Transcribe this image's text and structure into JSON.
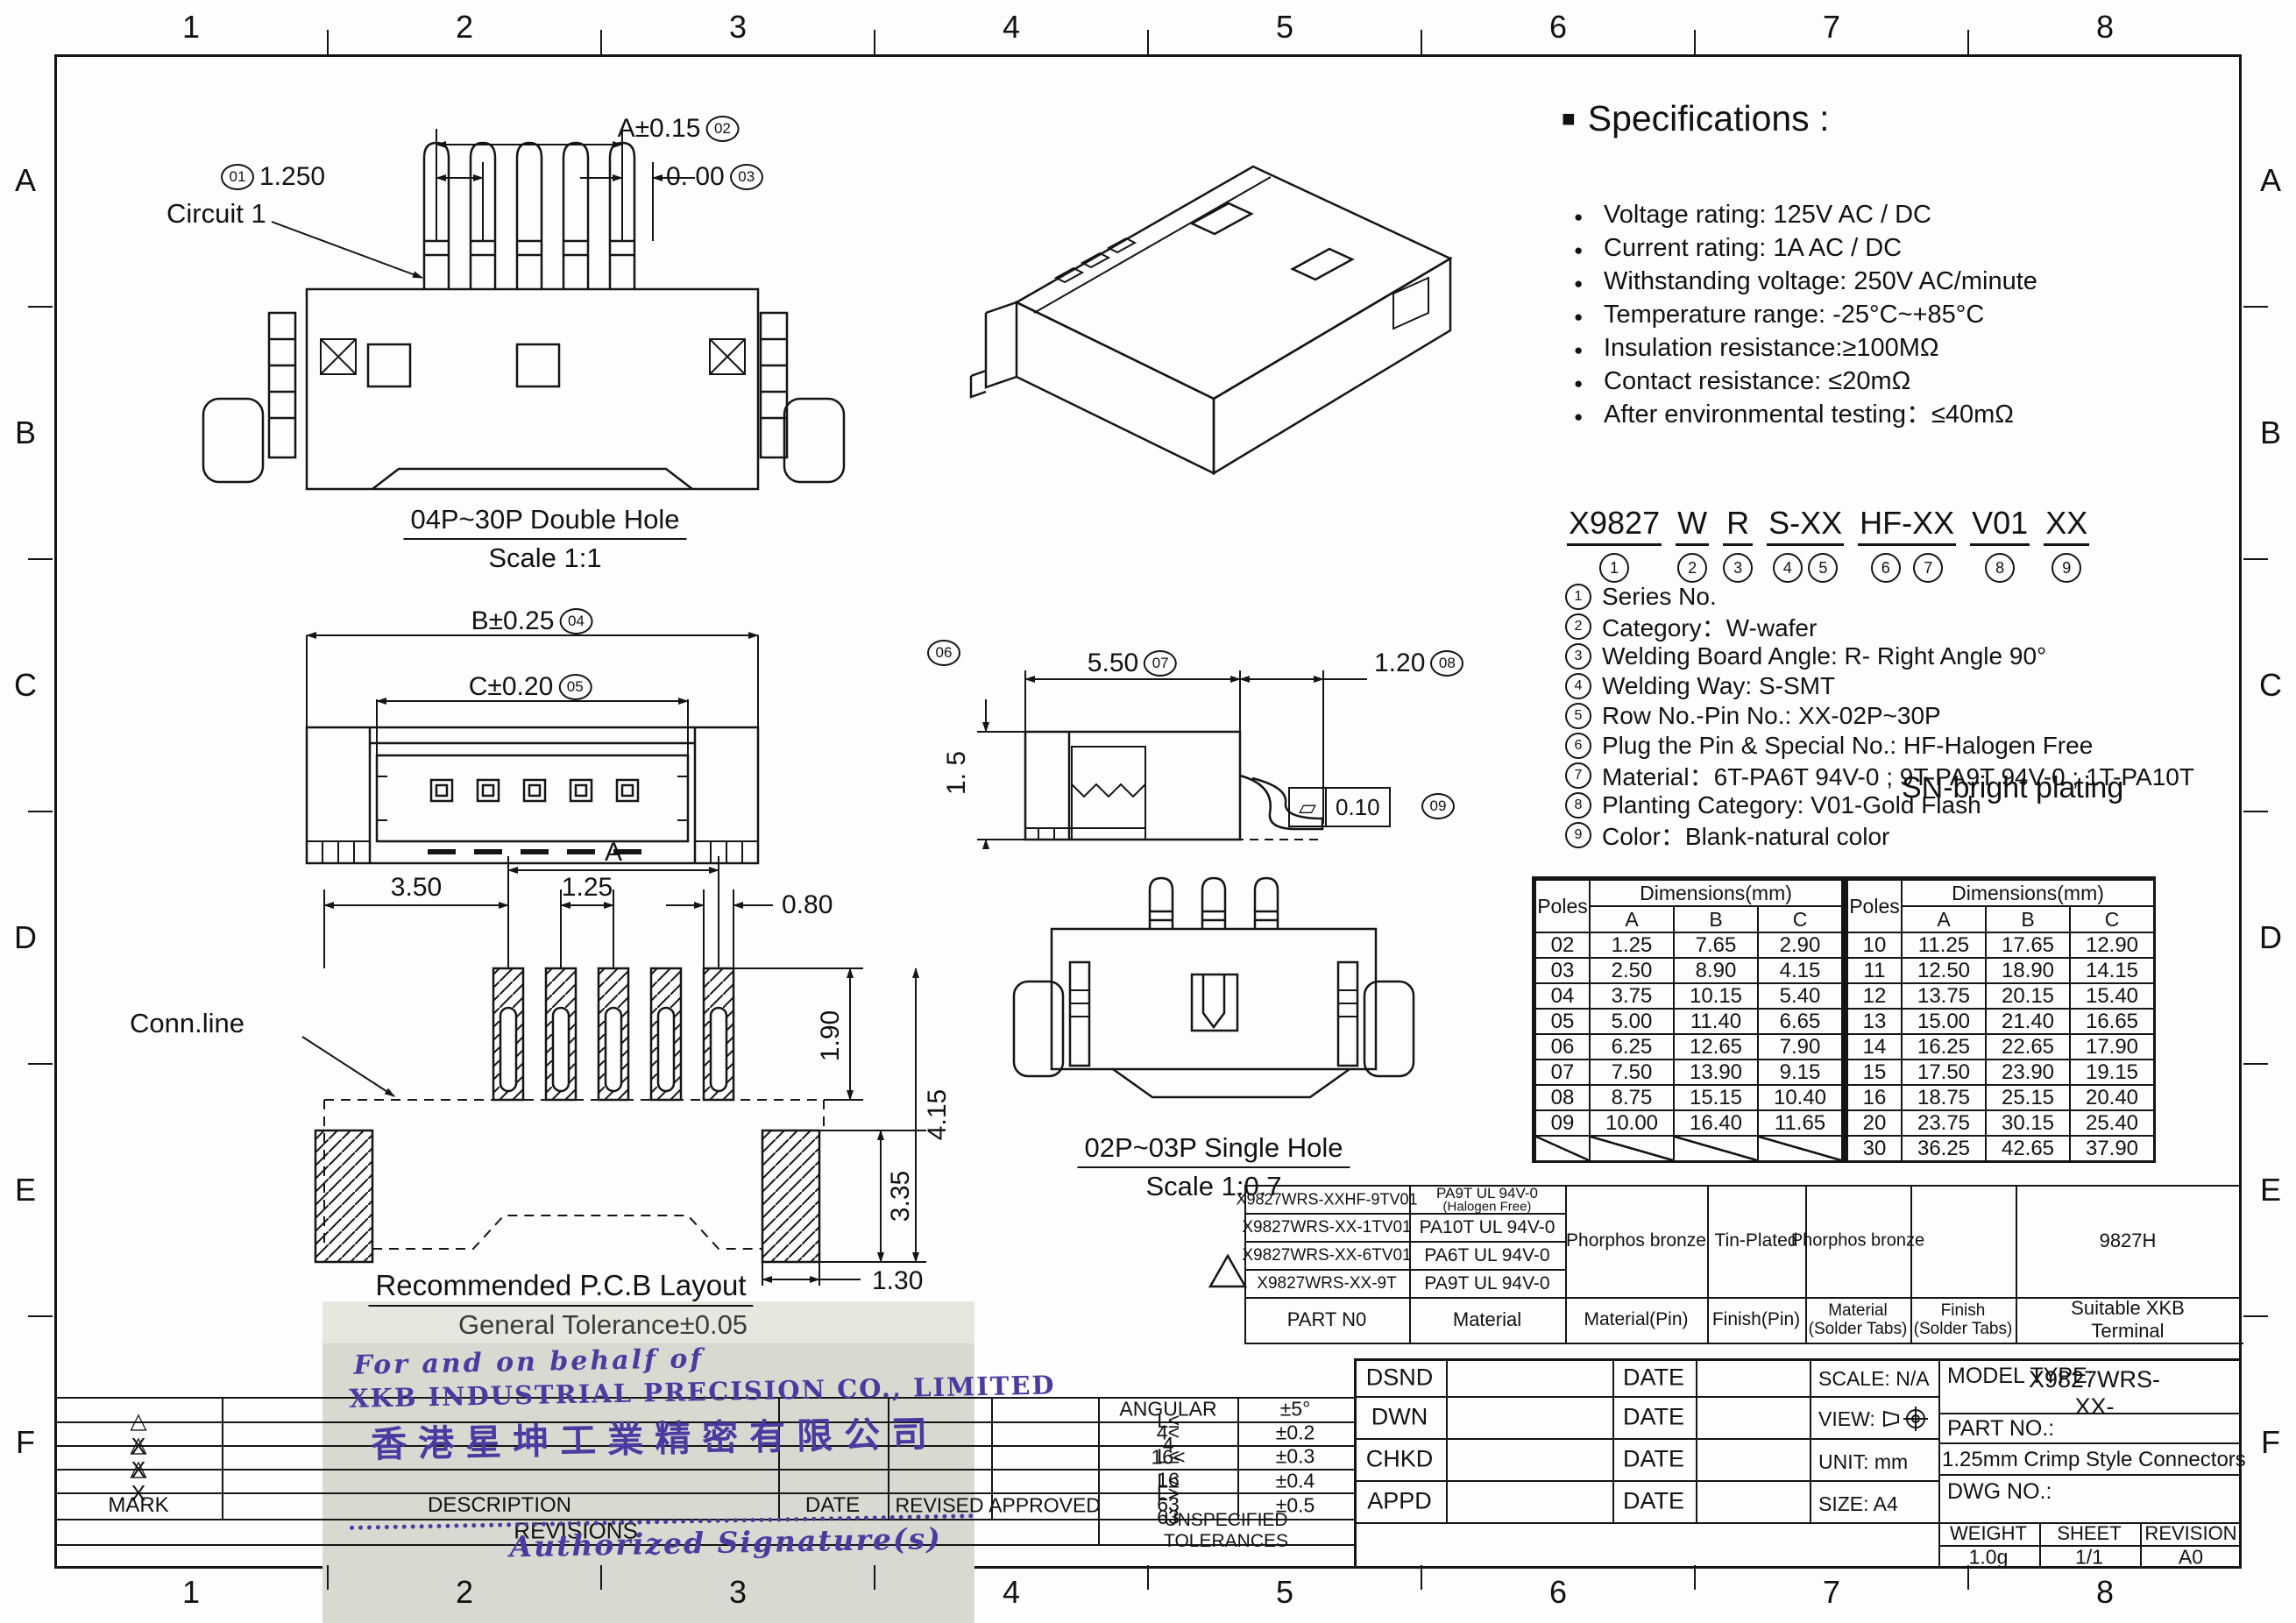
{
  "sheet": {
    "cols": [
      "1",
      "2",
      "3",
      "4",
      "5",
      "6",
      "7",
      "8"
    ],
    "rows_letters": [
      "A",
      "B",
      "C",
      "D",
      "E",
      "F"
    ]
  },
  "specs": {
    "title": "Specifications :",
    "items": [
      "Voltage rating: 125V AC / DC",
      "Current rating: 1A  AC / DC",
      "Withstanding voltage: 250V AC/minute",
      "Temperature range: -25°C~+85°C",
      "Insulation resistance:≥100MΩ",
      "Contact resistance: ≤20mΩ",
      "After environmental testing：≤40mΩ"
    ]
  },
  "part_code": {
    "segments": [
      {
        "text": "X9827",
        "refs": [
          "1"
        ]
      },
      {
        "text": "W",
        "refs": [
          "2"
        ]
      },
      {
        "text": "R",
        "refs": [
          "3"
        ]
      },
      {
        "text": "S-XX",
        "refs": [
          "4",
          "5"
        ]
      },
      {
        "text": "HF-XX",
        "refs": [
          "6",
          "7"
        ]
      },
      {
        "text": "V01",
        "refs": [
          "8"
        ]
      },
      {
        "text": "XX",
        "refs": [
          "9"
        ]
      }
    ],
    "notes": [
      {
        "ref": "1",
        "text": "Series No."
      },
      {
        "ref": "2",
        "text": "Category：W-wafer"
      },
      {
        "ref": "3",
        "text": "Welding Board Angle: R- Right Angle 90°"
      },
      {
        "ref": "4",
        "text": "Welding Way:  S-SMT"
      },
      {
        "ref": "5",
        "text": "Row No.-Pin No.:  XX-02P~30P"
      },
      {
        "ref": "6",
        "text": "Plug the Pin & Special No.: HF-Halogen Free"
      },
      {
        "ref": "7",
        "text": "Material：6T-PA6T 94V-0 ; 9T-PA9T 94V-0 ; 1T-PA10T"
      },
      {
        "ref": "8",
        "text": "Planting Category:  V01-Gold Flash"
      },
      {
        "ref": "9",
        "text": "Color：Blank-natural color"
      }
    ],
    "sn_note": "SN-bright plating"
  },
  "drawings": {
    "top_view": {
      "caption": "04P~30P Double Hole",
      "scale_note": "Scale 1:1",
      "circuit_label": "Circuit 1",
      "dim_span": "A±0.15",
      "dim_span_ref": "02",
      "dim_pitch": "1.250",
      "dim_pitch_ref": "01",
      "dim_zero": "0.  00",
      "dim_zero_ref": "03"
    },
    "front_view": {
      "dim_b": "B±0.25",
      "dim_b_ref": "04",
      "dim_c": "C±0.20",
      "dim_c_ref": "05"
    },
    "side_view": {
      "ref_height": "06",
      "dim_len": "5.50",
      "dim_len_ref": "07",
      "dim_tail": "1.20",
      "dim_tail_ref": "08",
      "dim_height": "1. 5",
      "flatness_symbol": "▱",
      "flatness_value": "0.10",
      "flatness_ref": "09"
    },
    "single_hole": {
      "caption": "02P~03P Single Hole",
      "scale_note": "Scale 1:0.7"
    },
    "pcb": {
      "caption": "Recommended P.C.B Layout",
      "tolerance_note": "General Tolerance±0.05",
      "conn_label": "Conn.line",
      "dim_offset": "3.50",
      "dim_pitch": "1.25",
      "dim_pad_w": "0.80",
      "dim_pad_h": "1.90",
      "dim_total_h": "4.15",
      "dim_tab_h": "3.35",
      "dim_tab_w": "1.30",
      "dim_span": "A"
    }
  },
  "chart_data": {
    "type": "table",
    "title": "Poles Dimensions(mm)",
    "columns": [
      "Poles",
      "A",
      "B",
      "C"
    ],
    "rows": [
      [
        "02",
        "1.25",
        "7.65",
        "2.90"
      ],
      [
        "03",
        "2.50",
        "8.90",
        "4.15"
      ],
      [
        "04",
        "3.75",
        "10.15",
        "5.40"
      ],
      [
        "05",
        "5.00",
        "11.40",
        "6.65"
      ],
      [
        "06",
        "6.25",
        "12.65",
        "7.90"
      ],
      [
        "07",
        "7.50",
        "13.90",
        "9.15"
      ],
      [
        "08",
        "8.75",
        "15.15",
        "10.40"
      ],
      [
        "09",
        "10.00",
        "16.40",
        "11.65"
      ],
      [
        "10",
        "11.25",
        "17.65",
        "12.90"
      ],
      [
        "11",
        "12.50",
        "18.90",
        "14.15"
      ],
      [
        "12",
        "13.75",
        "20.15",
        "15.40"
      ],
      [
        "13",
        "15.00",
        "21.40",
        "16.65"
      ],
      [
        "14",
        "16.25",
        "22.65",
        "17.90"
      ],
      [
        "15",
        "17.50",
        "23.90",
        "19.15"
      ],
      [
        "16",
        "18.75",
        "25.15",
        "20.40"
      ],
      [
        "20",
        "23.75",
        "30.15",
        "25.40"
      ],
      [
        "30",
        "36.25",
        "42.65",
        "37.90"
      ]
    ]
  },
  "poles_table": {
    "head_poles": "Poles",
    "head_dim": "Dimensions(mm)",
    "cols": [
      "A",
      "B",
      "C"
    ],
    "left_rows": [
      [
        "02",
        "1.25",
        "7.65",
        "2.90"
      ],
      [
        "03",
        "2.50",
        "8.90",
        "4.15"
      ],
      [
        "04",
        "3.75",
        "10.15",
        "5.40"
      ],
      [
        "05",
        "5.00",
        "11.40",
        "6.65"
      ],
      [
        "06",
        "6.25",
        "12.65",
        "7.90"
      ],
      [
        "07",
        "7.50",
        "13.90",
        "9.15"
      ],
      [
        "08",
        "8.75",
        "15.15",
        "10.40"
      ],
      [
        "09",
        "10.00",
        "16.40",
        "11.65"
      ]
    ],
    "right_rows": [
      [
        "10",
        "11.25",
        "17.65",
        "12.90"
      ],
      [
        "11",
        "12.50",
        "18.90",
        "14.15"
      ],
      [
        "12",
        "13.75",
        "20.15",
        "15.40"
      ],
      [
        "13",
        "15.00",
        "21.40",
        "16.65"
      ],
      [
        "14",
        "16.25",
        "22.65",
        "17.90"
      ],
      [
        "15",
        "17.50",
        "23.90",
        "19.15"
      ],
      [
        "16",
        "18.75",
        "25.15",
        "20.40"
      ],
      [
        "20",
        "23.75",
        "30.15",
        "25.40"
      ],
      [
        "30",
        "36.25",
        "42.65",
        "37.90"
      ]
    ]
  },
  "material_table": {
    "rows": [
      {
        "part": "X9827WRS-XXHF-9TV01",
        "material": "PA9T  UL 94V-0",
        "material2": "(Halogen Free)"
      },
      {
        "part": "X9827WRS-XX-1TV01",
        "material": "PA10T  UL 94V-0",
        "material2": ""
      },
      {
        "part": "X9827WRS-XX-6TV01",
        "material": "PA6T  UL 94V-0",
        "material2": ""
      },
      {
        "part": "X9827WRS-XX-9T",
        "material": "PA9T  UL 94V-0",
        "material2": ""
      }
    ],
    "span": {
      "material_pin": "Phorphos bronze",
      "finish_pin": "Tin-Plated",
      "material_tabs": "Phorphos bronze",
      "finish_tabs": "",
      "terminal": "9827H"
    },
    "footer": {
      "part": "PART N0",
      "material": "Material",
      "material_pin": "Material(Pin)",
      "finish_pin": "Finish(Pin)",
      "material_tabs": "Material\n(Solder Tabs)",
      "finish_tabs": "Finish\n(Solder Tabs)",
      "terminal": "Suitable XKB Terminal"
    }
  },
  "tolerance_table": {
    "rows": [
      [
        "ANGULAR",
        "±5°"
      ],
      [
        "L≤ 4",
        "±0.2"
      ],
      [
        "4< L≤ 16",
        "±0.3"
      ],
      [
        "16< L≤ 63",
        "±0.4"
      ],
      [
        "L> 63",
        "±0.5"
      ]
    ],
    "footer": "UNSPECIFIED  TOLERANCES"
  },
  "revisions_block": {
    "mark_rows": [
      "△ X",
      "△ X",
      "△ X"
    ],
    "mark_label": "MARK",
    "description": "DESCRIPTION",
    "date": "DATE",
    "revised": "REVISED",
    "approved": "APPROVED",
    "caption": "REVISIONS"
  },
  "title_block": {
    "rows": [
      {
        "label": "DSND",
        "date": "DATE"
      },
      {
        "label": "DWN",
        "date": "DATE"
      },
      {
        "label": "CHKD",
        "date": "DATE"
      },
      {
        "label": "APPD",
        "date": "DATE"
      }
    ],
    "scale": "SCALE: N/A",
    "view": "VIEW:",
    "unit": "UNIT:  mm",
    "size": "SIZE:  A4",
    "model_type_label": "MODEL TYPE:",
    "model_type": "X9827WRS-XX-",
    "part_no_label": "PART NO.:",
    "part_name": "1.25mm Crimp Style Connectors",
    "dwg_no_label": "DWG NO.:",
    "weight_label": "WEIGHT",
    "sheet_label": "SHEET",
    "revision_label": "REVISION",
    "weight": "1.0g",
    "sheet_no": "1/1",
    "revision": "A0"
  },
  "stamp": {
    "preface": "For and on behalf of",
    "company_en": "XKB INDUSTRIAL PRECISION CO., LIMITED",
    "company_zh": "香港星坤工業精密有限公司",
    "signature": "Authorized Signature(s)"
  }
}
